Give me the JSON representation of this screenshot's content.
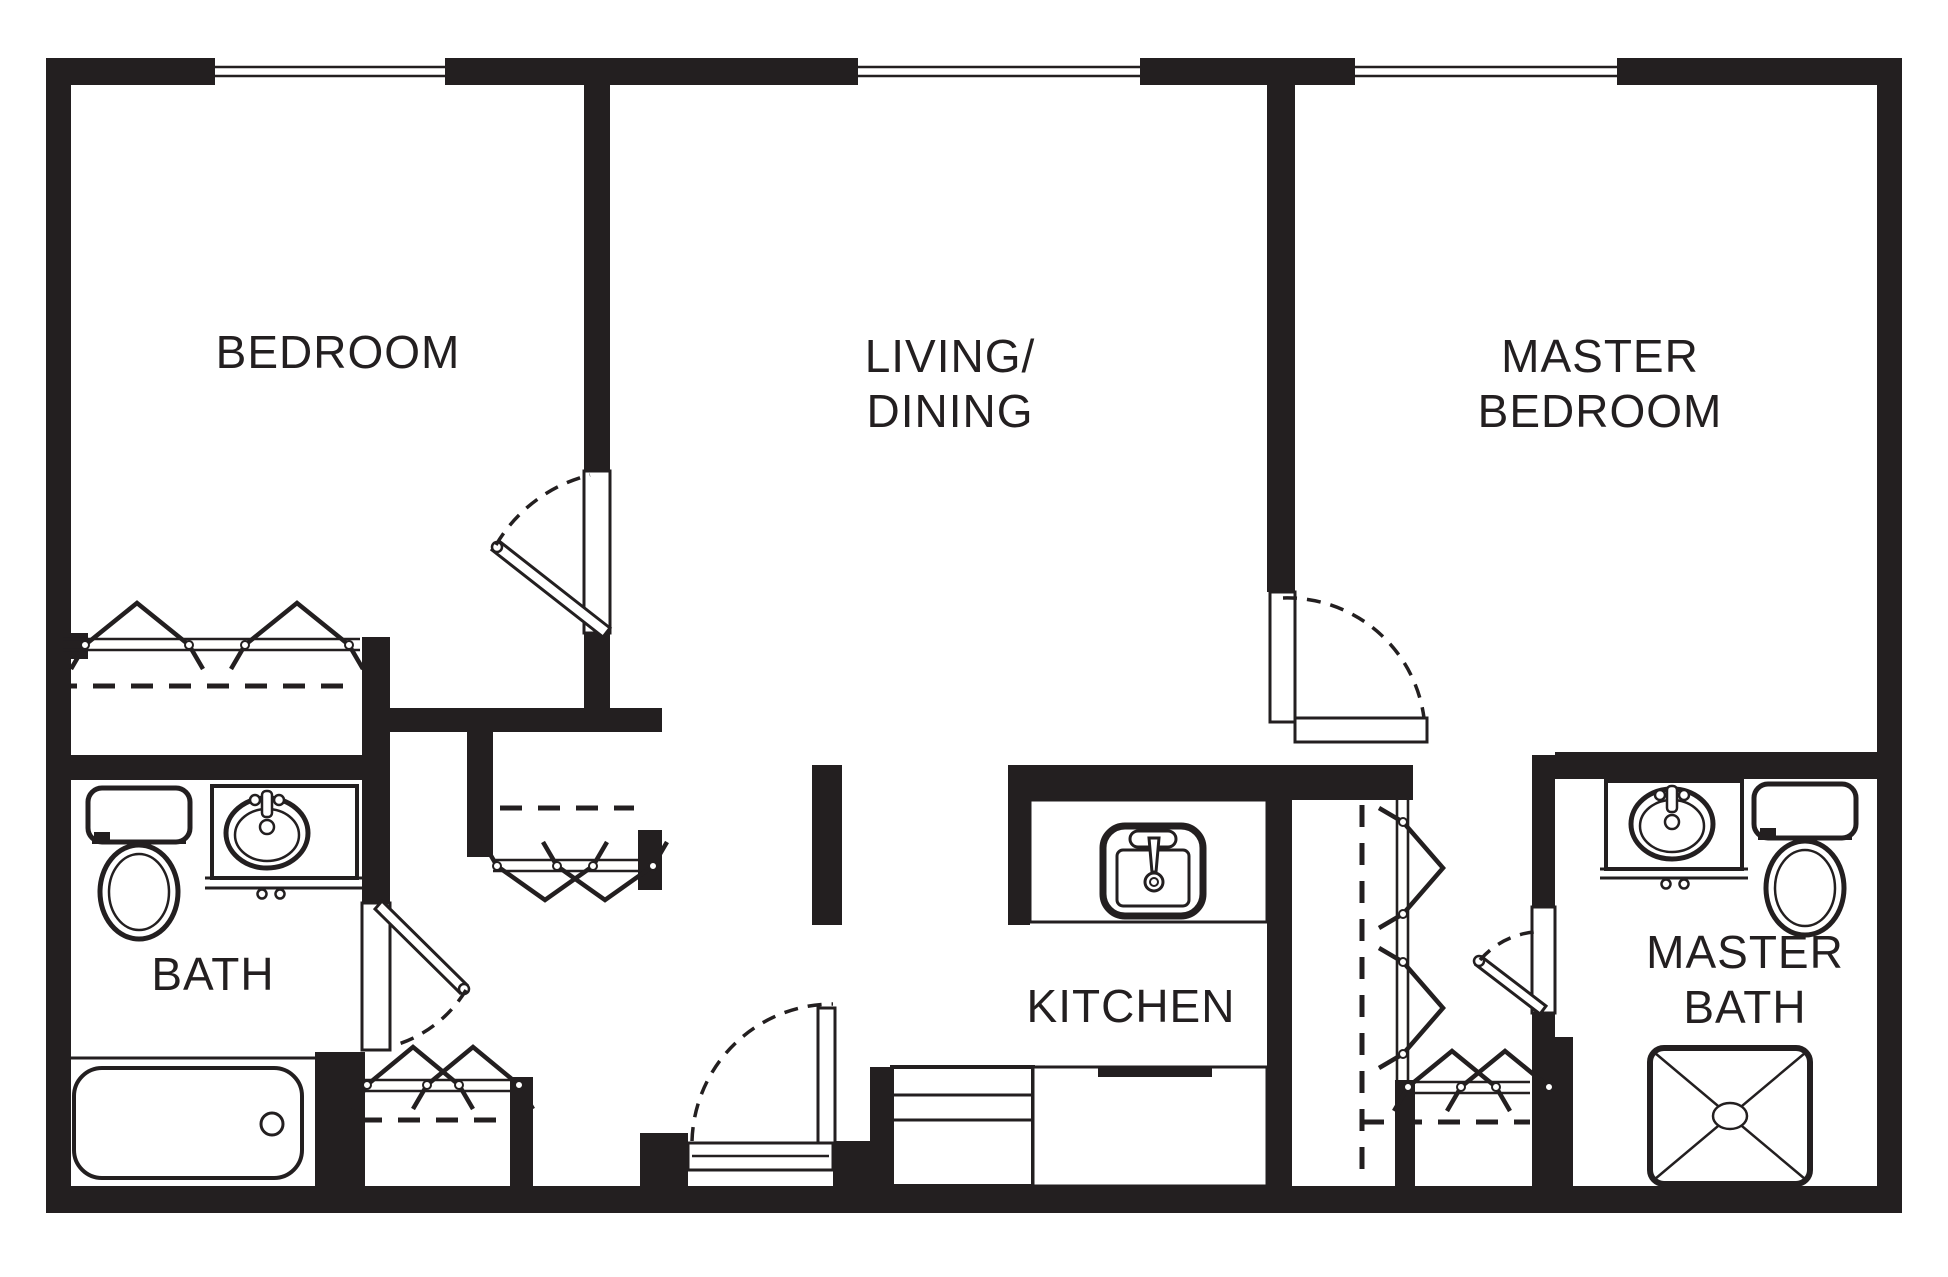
{
  "canvas": {
    "w": 1948,
    "h": 1277,
    "bg": "#ffffff",
    "ink": "#231f20"
  },
  "labels": [
    {
      "id": "bedroom-label",
      "text": "BEDROOM",
      "x": 338,
      "y": 368
    },
    {
      "id": "living-label-1",
      "text": "LIVING/",
      "x": 950,
      "y": 372
    },
    {
      "id": "living-label-2",
      "text": "DINING",
      "x": 950,
      "y": 427
    },
    {
      "id": "master-bedroom-label-1",
      "text": "MASTER",
      "x": 1600,
      "y": 372
    },
    {
      "id": "master-bedroom-label-2",
      "text": "BEDROOM",
      "x": 1600,
      "y": 427
    },
    {
      "id": "bath-label",
      "text": "BATH",
      "x": 213,
      "y": 990
    },
    {
      "id": "kitchen-label",
      "text": "KITCHEN",
      "x": 1131,
      "y": 1022
    },
    {
      "id": "master-bath-label-1",
      "text": "MASTER",
      "x": 1745,
      "y": 968
    },
    {
      "id": "master-bath-label-2",
      "text": "BATH",
      "x": 1745,
      "y": 1023
    }
  ],
  "font_size": 46,
  "walls": [
    {
      "n": "wall-exterior-top",
      "x": 46,
      "y": 58,
      "w": 1856,
      "h": 27
    },
    {
      "n": "wall-exterior-bottom",
      "x": 46,
      "y": 1186,
      "w": 1856,
      "h": 27
    },
    {
      "n": "wall-exterior-left",
      "x": 46,
      "y": 58,
      "w": 25,
      "h": 1155
    },
    {
      "n": "wall-exterior-right",
      "x": 1877,
      "y": 58,
      "w": 25,
      "h": 1155
    },
    {
      "n": "wall-bedroom-living-upper",
      "x": 584,
      "y": 85,
      "w": 26,
      "h": 386
    },
    {
      "n": "wall-bedroom-living-lower",
      "x": 584,
      "y": 633,
      "w": 26,
      "h": 99
    },
    {
      "n": "wall-hall-north",
      "x": 390,
      "y": 708,
      "w": 272,
      "h": 24
    },
    {
      "n": "wall-bath-hall",
      "x": 362,
      "y": 637,
      "w": 28,
      "h": 266
    },
    {
      "n": "wall-bath-north",
      "x": 46,
      "y": 755,
      "w": 344,
      "h": 25
    },
    {
      "n": "wall-bedroom-closet-jamb",
      "x": 46,
      "y": 633,
      "w": 42,
      "h": 26
    },
    {
      "n": "wall-hall-closet-stub",
      "x": 467,
      "y": 732,
      "w": 26,
      "h": 125
    },
    {
      "n": "wall-hall-closet-jamb-east",
      "x": 638,
      "y": 830,
      "w": 24,
      "h": 60
    },
    {
      "n": "wall-tub-closet-block",
      "x": 315,
      "y": 1052,
      "w": 50,
      "h": 134
    },
    {
      "n": "wall-south-closet-east",
      "x": 510,
      "y": 1077,
      "w": 23,
      "h": 109
    },
    {
      "n": "wall-entry-jamb-west",
      "x": 640,
      "y": 1133,
      "w": 48,
      "h": 53
    },
    {
      "n": "wall-entry-jamb-east",
      "x": 833,
      "y": 1141,
      "w": 65,
      "h": 45
    },
    {
      "n": "wall-kitchen-west-stub",
      "x": 812,
      "y": 765,
      "w": 30,
      "h": 160
    },
    {
      "n": "wall-kitchen-north-band",
      "x": 1008,
      "y": 765,
      "w": 405,
      "h": 35
    },
    {
      "n": "wall-kitchen-counter-cap",
      "x": 1008,
      "y": 765,
      "w": 22,
      "h": 160
    },
    {
      "n": "wall-living-master-upper",
      "x": 1267,
      "y": 85,
      "w": 28,
      "h": 507
    },
    {
      "n": "wall-living-master-lower",
      "x": 1267,
      "y": 800,
      "w": 25,
      "h": 386
    },
    {
      "n": "wall-master-bath-west-upper",
      "x": 1532,
      "y": 755,
      "w": 23,
      "h": 152
    },
    {
      "n": "wall-master-bath-west-stub",
      "x": 1532,
      "y": 1013,
      "w": 23,
      "h": 24
    },
    {
      "n": "wall-master-bath-west-block",
      "x": 1532,
      "y": 1037,
      "w": 41,
      "h": 151
    },
    {
      "n": "wall-master-bath-north",
      "x": 1555,
      "y": 752,
      "w": 347,
      "h": 27
    },
    {
      "n": "wall-master-closet-block",
      "x": 1395,
      "y": 1080,
      "w": 20,
      "h": 106
    },
    {
      "n": "wall-kitchen-lower-stub",
      "x": 870,
      "y": 1067,
      "w": 22,
      "h": 119
    }
  ],
  "windows": [
    {
      "n": "window-bedroom",
      "x": 215,
      "y": 58,
      "w": 230,
      "h": 27
    },
    {
      "n": "window-living",
      "x": 858,
      "y": 58,
      "w": 282,
      "h": 27
    },
    {
      "n": "window-master-bedroom",
      "x": 1355,
      "y": 58,
      "w": 262,
      "h": 27
    }
  ],
  "thresholds": [
    {
      "n": "door-bedroom-threshold",
      "x": 584,
      "y": 471,
      "w": 26,
      "h": 162
    },
    {
      "n": "door-bath-threshold",
      "x": 362,
      "y": 903,
      "w": 28,
      "h": 147
    },
    {
      "n": "door-master-bedroom-threshold",
      "x": 1295,
      "y": 718,
      "w": 132,
      "h": 24
    },
    {
      "n": "door-entry-threshold",
      "x": 688,
      "y": 1143,
      "w": 145,
      "h": 27
    },
    {
      "n": "door-master-bath-threshold",
      "x": 1532,
      "y": 907,
      "w": 23,
      "h": 106
    },
    {
      "n": "door-master-bedroom-leaf",
      "x": 1270,
      "y": 592,
      "w": 25,
      "h": 130
    },
    {
      "n": "door-entry-leaf",
      "x": 818,
      "y": 1008,
      "w": 17,
      "h": 135
    }
  ],
  "leaf_polys": [
    {
      "n": "door-bedroom-leaf",
      "pts": "610,628 499,541 492,550 603,637",
      "pivot": [
        497,
        547
      ]
    },
    {
      "n": "door-bath-leaf",
      "pts": "382,901 467,985 460,993 375,909",
      "pivot": [
        464,
        989
      ]
    },
    {
      "n": "door-master-bath-leaf",
      "pts": "1546,1006 1482,957 1476,965 1540,1014",
      "pivot": [
        1479,
        961
      ]
    }
  ],
  "arcs": [
    {
      "n": "door-bedroom-swing",
      "d": "M 496 545 A 150 150 0 0 1 590 475"
    },
    {
      "n": "door-bath-swing",
      "d": "M 466 990 A 125 125 0 0 1 392 1046"
    },
    {
      "n": "door-master-bedroom-swing",
      "d": "M 1283 598 A 138 138 0 0 1 1424 718"
    },
    {
      "n": "door-entry-swing",
      "d": "M 692 1141 A 141 141 0 0 1 833 1004"
    },
    {
      "n": "door-master-bath-swing",
      "d": "M 1480 960 A 82 82 0 0 1 1534 932"
    }
  ],
  "dashes": [
    {
      "n": "closet-rod-bedroom",
      "x1": 55,
      "y1": 686,
      "x2": 358,
      "y2": 686
    },
    {
      "n": "closet-rod-hall-east",
      "x1": 500,
      "y1": 808,
      "x2": 634,
      "y2": 808
    },
    {
      "n": "closet-rod-hall-south",
      "x1": 322,
      "y1": 1120,
      "x2": 510,
      "y2": 1120
    },
    {
      "n": "closet-rod-master-vertical",
      "x1": 1362,
      "y1": 805,
      "x2": 1362,
      "y2": 1183
    },
    {
      "n": "closet-rod-master-south",
      "x1": 1362,
      "y1": 1122,
      "x2": 1530,
      "y2": 1122
    }
  ],
  "tracks": [
    {
      "n": "bifold-track-bedroom",
      "o": "h",
      "a": 63,
      "b": 360,
      "p": 639,
      "q": 650
    },
    {
      "n": "bifold-track-hall-east",
      "o": "h",
      "a": 493,
      "b": 638,
      "p": 860,
      "q": 871
    },
    {
      "n": "bifold-track-hall-south",
      "o": "h",
      "a": 365,
      "b": 510,
      "p": 1080,
      "q": 1091
    },
    {
      "n": "bifold-track-master-south",
      "o": "h",
      "a": 1415,
      "b": 1530,
      "p": 1082,
      "q": 1093
    },
    {
      "n": "bifold-track-master-vertical",
      "o": "v",
      "a": 800,
      "b": 1080,
      "p": 1397,
      "q": 1408
    }
  ],
  "zigzags": [
    {
      "n": "bifold-doors-bedroom",
      "o": "h",
      "line": 645,
      "apex": -42,
      "span": 52,
      "cs": [
        137,
        297
      ]
    },
    {
      "n": "bifold-doors-hall-east",
      "o": "h",
      "line": 866,
      "apex": 34,
      "span": 48,
      "cs": [
        545,
        605
      ]
    },
    {
      "n": "bifold-doors-hall-south",
      "o": "h",
      "line": 1085,
      "apex": -38,
      "span": 46,
      "cs": [
        413,
        473
      ]
    },
    {
      "n": "bifold-doors-master-south",
      "o": "h",
      "line": 1087,
      "apex": -36,
      "span": 44,
      "cs": [
        1452,
        1505
      ]
    },
    {
      "n": "bifold-doors-master-vertical",
      "o": "v",
      "line": 1403,
      "apex": 40,
      "span": 46,
      "cs": [
        868,
        1008
      ]
    }
  ],
  "lines": [
    {
      "n": "tub-alcove-edge",
      "x1": 70,
      "y1": 1058,
      "x2": 315,
      "y2": 1058,
      "sw": 3
    },
    {
      "n": "kitchen-counter-bottom-edge",
      "x1": 1008,
      "y1": 922,
      "x2": 1267,
      "y2": 922,
      "sw": 3
    },
    {
      "n": "bath-counter-front-1",
      "x1": 205,
      "y1": 878,
      "x2": 362,
      "y2": 878,
      "sw": 3
    },
    {
      "n": "bath-counter-front-2",
      "x1": 205,
      "y1": 888,
      "x2": 362,
      "y2": 888,
      "sw": 3
    },
    {
      "n": "master-counter-front-1",
      "x1": 1600,
      "y1": 869,
      "x2": 1748,
      "y2": 869,
      "sw": 3
    },
    {
      "n": "master-counter-front-2",
      "x1": 1600,
      "y1": 878,
      "x2": 1748,
      "y2": 878,
      "sw": 3
    },
    {
      "n": "range-line-1",
      "x1": 892,
      "y1": 1095,
      "x2": 1033,
      "y2": 1095,
      "sw": 3
    },
    {
      "n": "range-line-2",
      "x1": 892,
      "y1": 1120,
      "x2": 1033,
      "y2": 1120,
      "sw": 3
    },
    {
      "n": "entry-sill-line",
      "x1": 692,
      "y1": 1156,
      "x2": 829,
      "y2": 1156,
      "sw": 2.5
    }
  ],
  "white_boxes": [
    {
      "n": "bath-sink-counter",
      "x": 212,
      "y": 786,
      "w": 145,
      "h": 92,
      "sw": 4
    },
    {
      "n": "master-sink-counter",
      "x": 1606,
      "y": 781,
      "w": 136,
      "h": 88,
      "sw": 4
    },
    {
      "n": "kitchen-counter-north",
      "x": 1030,
      "y": 800,
      "w": 237,
      "h": 122,
      "sw": 3
    },
    {
      "n": "kitchen-range-box",
      "x": 892,
      "y": 1067,
      "w": 141,
      "h": 119,
      "sw": 4
    },
    {
      "n": "kitchen-counter-south",
      "x": 1033,
      "y": 1067,
      "w": 234,
      "h": 119,
      "sw": 3
    }
  ],
  "black_strips": [
    {
      "n": "kitchen-range-strip",
      "x": 1098,
      "y": 1067,
      "w": 114,
      "h": 10
    }
  ],
  "fixtures": {
    "toilets": [
      {
        "n": "bath-toilet",
        "x": 88,
        "y": 788
      },
      {
        "n": "master-bath-toilet",
        "x": 1754,
        "y": 784
      }
    ],
    "basins": [
      {
        "n": "bath-sink",
        "cx": 267,
        "cy": 833,
        "fy": 800,
        "fx1": 255,
        "fx2": 279
      },
      {
        "n": "master-bath-sink",
        "cx": 1672,
        "cy": 824,
        "fy": 795,
        "fx1": 1660,
        "fx2": 1684
      }
    ],
    "pulls": [
      {
        "n": "bath-counter-pulls",
        "pts": [
          [
            262,
            894
          ],
          [
            280,
            894
          ]
        ]
      },
      {
        "n": "master-counter-pulls",
        "pts": [
          [
            1666,
            884
          ],
          [
            1684,
            884
          ]
        ]
      }
    ],
    "tub": {
      "n": "bathtub",
      "x": 74,
      "y": 1068,
      "w": 228,
      "h": 110,
      "drain": [
        272,
        1124
      ]
    },
    "shower": {
      "n": "master-shower",
      "x": 1650,
      "y": 1048,
      "w": 160,
      "h": 136
    },
    "ksink": {
      "n": "kitchen-sink",
      "x": 1103,
      "y": 826,
      "w": 100,
      "h": 90
    }
  }
}
